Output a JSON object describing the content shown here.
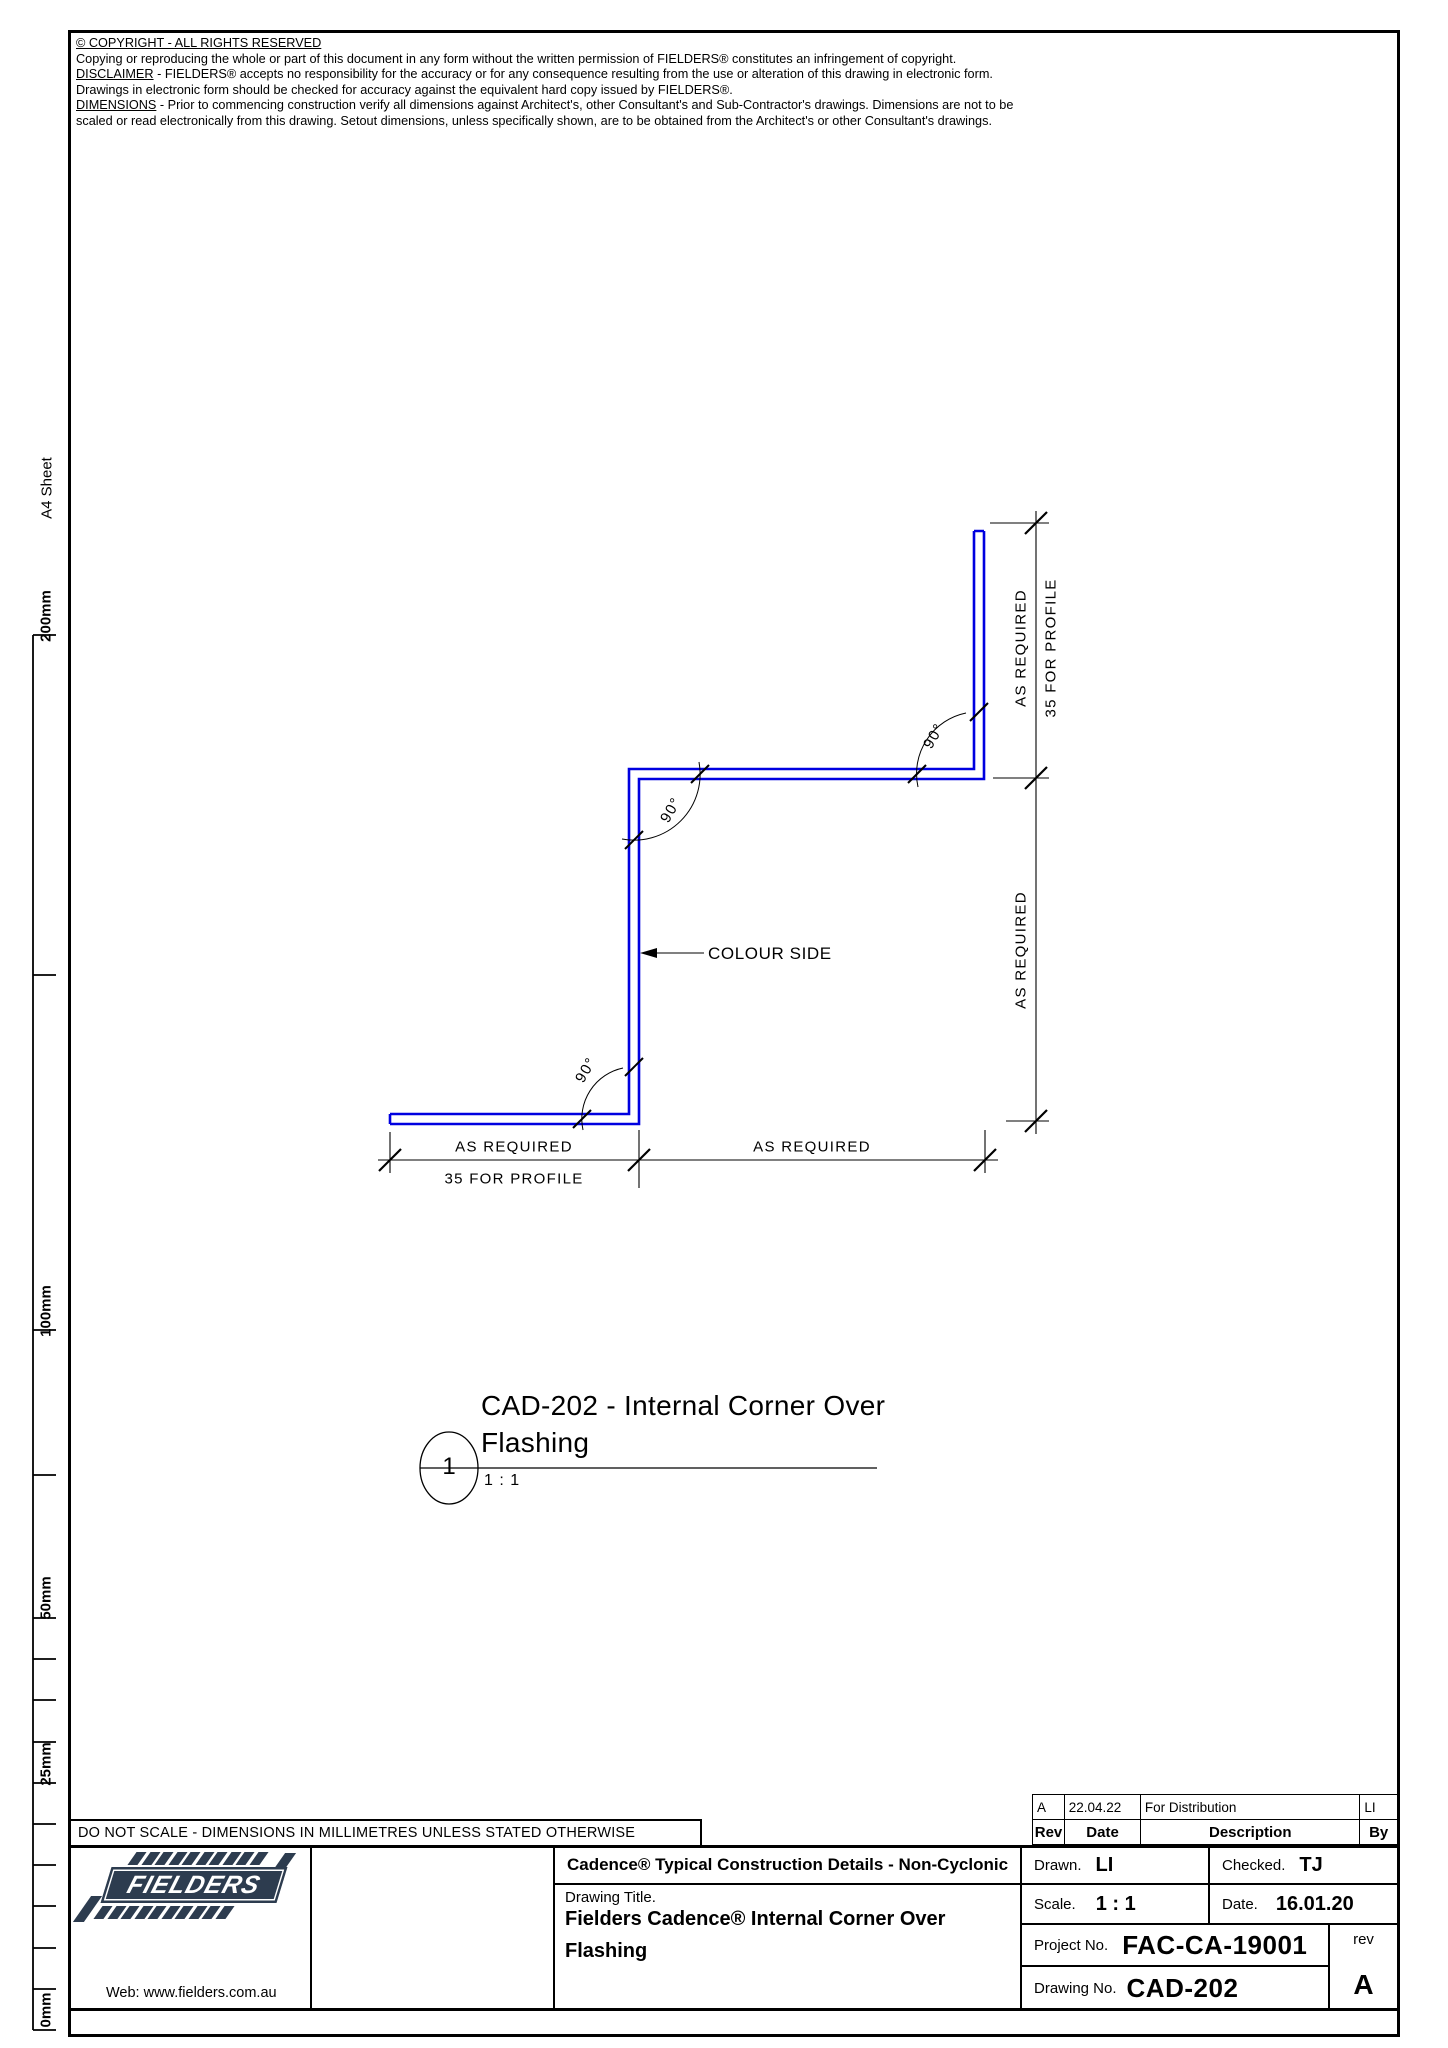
{
  "sheet": {
    "margin": {
      "sheet_label": "A4 Sheet",
      "ruler_labels": [
        "200mm",
        "100mm",
        "50mm",
        "25mm",
        "0mm"
      ]
    },
    "notices": {
      "copyright_title": "© COPYRIGHT - ALL RIGHTS RESERVED",
      "copyright_body": "Copying or reproducing the whole or part of this document in any form without the written permission of FIELDERS® constitutes an infringement of copyright.",
      "disclaimer_label": "DISCLAIMER",
      "disclaimer_body": " - FIELDERS® accepts no responsibility for the accuracy or for any consequence resulting from the use or alteration of this drawing in electronic form.  Drawings in electronic form should be checked for accuracy against the equivalent hard copy issued by FIELDERS®.",
      "dimensions_label": "DIMENSIONS",
      "dimensions_body": " - Prior to commencing construction verify all dimensions against Architect's, other Consultant's and Sub-Contractor's drawings. Dimensions are not to be scaled or read electronically from this drawing. Setout dimensions, unless specifically shown, are to be obtained from the Architect's or other Consultant's drawings."
    }
  },
  "drawing": {
    "profile_color": "#0000e0",
    "colour_side_label": "COLOUR SIDE",
    "angles": {
      "top_left": "90°",
      "bottom_left": "90°",
      "top_right": "90°"
    },
    "dims": {
      "bottom_left_primary": "AS REQUIRED",
      "bottom_left_secondary": "35 FOR PROFILE",
      "bottom_right": "AS REQUIRED",
      "right_top_primary": "AS REQUIRED",
      "right_top_secondary": "35 FOR PROFILE",
      "right_bottom": "AS REQUIRED"
    },
    "view": {
      "number": "1",
      "title_line1": "CAD-202 - Internal Corner Over",
      "title_line2": "Flashing",
      "scale": "1 : 1"
    }
  },
  "revision_table": {
    "entry": {
      "rev": "A",
      "date": "22.04.22",
      "description": "For Distribution",
      "by": "LI"
    },
    "header": {
      "rev": "Rev",
      "date": "Date",
      "description": "Description",
      "by": "By"
    }
  },
  "title_block": {
    "do_not_scale": "DO NOT SCALE - DIMENSIONS IN MILLIMETRES UNLESS STATED OTHERWISE",
    "logo_text": "FIELDERS",
    "web": "Web: www.fielders.com.au",
    "series_title": "Cadence® Typical Construction Details - Non-Cyclonic",
    "drawing_title_label": "Drawing Title.",
    "drawing_title_line1": "Fielders Cadence® Internal Corner Over",
    "drawing_title_line2": "Flashing",
    "drawn_label": "Drawn.",
    "drawn_value": "LI",
    "checked_label": "Checked.",
    "checked_value": "TJ",
    "scale_label": "Scale.",
    "scale_value": "1 : 1",
    "date_label": "Date.",
    "date_value": "16.01.20",
    "project_label": "Project No.",
    "project_value": "FAC-CA-19001",
    "drawing_no_label": "Drawing No.",
    "drawing_no_value": "CAD-202",
    "rev_label": "rev",
    "rev_value": "A"
  }
}
